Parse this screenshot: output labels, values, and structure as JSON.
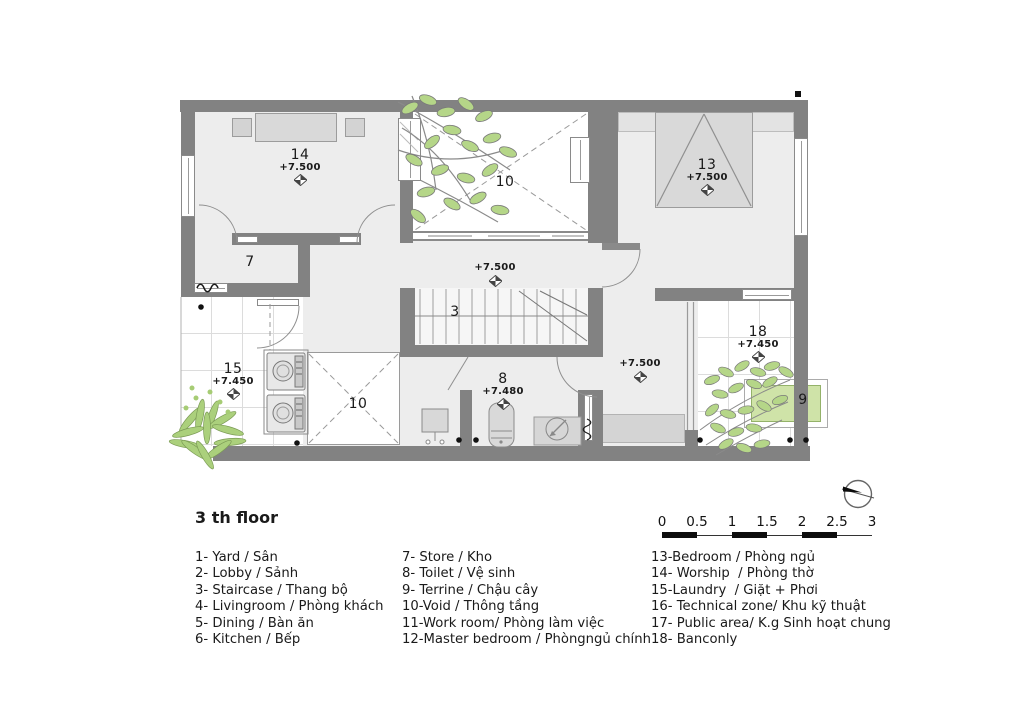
{
  "sheet": {
    "title": "3 th floor"
  },
  "plan": {
    "labels": {
      "room14": {
        "num": "14",
        "elev": "+7.500"
      },
      "room13": {
        "num": "13",
        "elev": "+7.500"
      },
      "void_top": {
        "num": "10"
      },
      "corridor": {
        "elev": "+7.500"
      },
      "stairs": {
        "num": "3"
      },
      "room7": {
        "num": "7"
      },
      "room15": {
        "num": "15",
        "elev": "+7.450"
      },
      "void_bottom": {
        "num": "10"
      },
      "toilet": {
        "num": "8",
        "elev": "+7.480"
      },
      "midroom": {
        "elev": "+7.500"
      },
      "balcony": {
        "num": "18",
        "elev": "+7.450"
      },
      "planter": {
        "num": "9"
      }
    },
    "colors": {
      "wall": "#828282",
      "room_fill": "#ededed",
      "furniture": "#d9d9d9",
      "leaf_green": "#b5d688",
      "planter_green": "#cfe3a8"
    }
  },
  "scale_bar": {
    "ticks": [
      "0",
      "0.5",
      "1",
      "1.5",
      "2",
      "2.5",
      "3"
    ]
  },
  "legend": {
    "col1": [
      "1- Yard / Sân",
      "2- Lobby / Sảnh",
      "3- Staircase / Thang bộ",
      "4- Livingroom / Phòng khách",
      "5- Dining / Bàn ăn",
      "6- Kitchen / Bếp"
    ],
    "col2": [
      "7- Store / Kho",
      "8- Toilet / Vệ sinh",
      "9- Terrine / Chậu cây",
      "10-Void / Thông tầng",
      "11-Work room/ Phòng làm việc",
      "12-Master bedroom / Phòngngủ chính"
    ],
    "col3": [
      "13-Bedroom / Phòng ngủ",
      "14- Worship  / Phòng thờ",
      "15-Laundry  / Giặt + Phơi",
      "16- Technical zone/ Khu kỹ thuật",
      "17- Public area/ K.g Sinh hoạt chung",
      "18- Banconly"
    ]
  }
}
